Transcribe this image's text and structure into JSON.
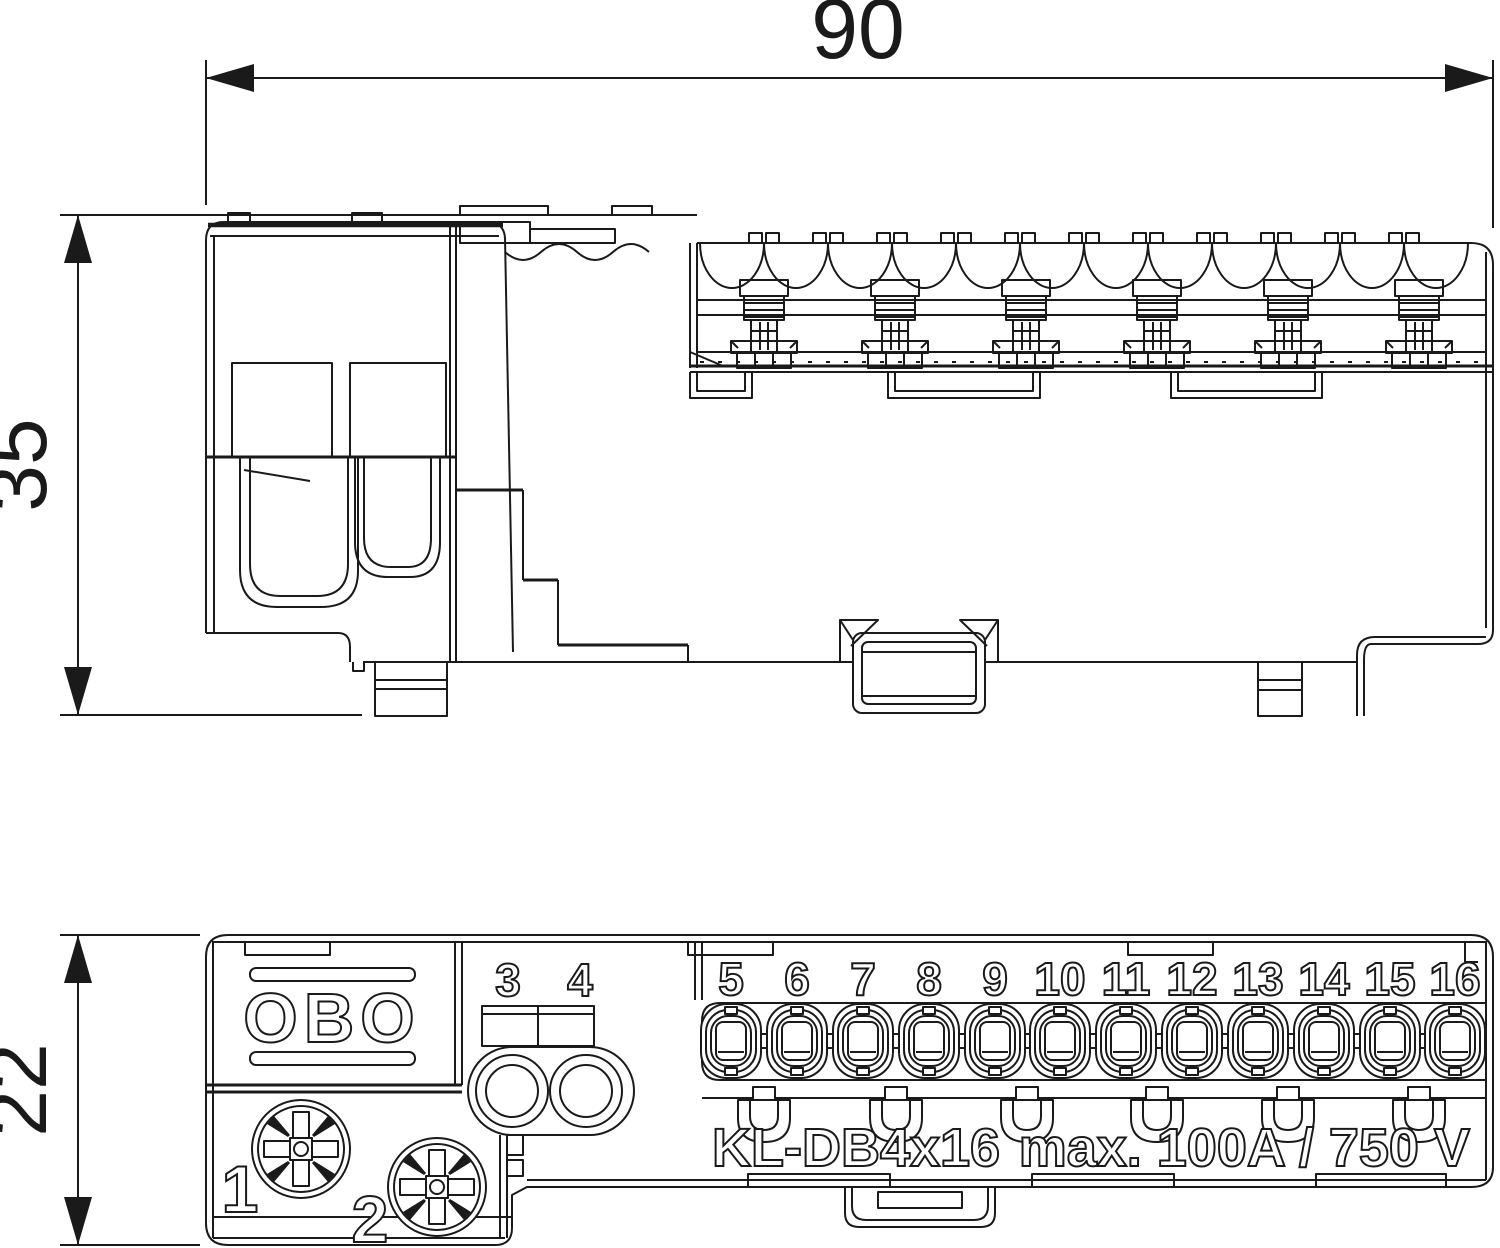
{
  "drawing": {
    "title": "Terminal block dimension drawing",
    "colors": {
      "line": "#1a1a1a",
      "background": "#ffffff"
    },
    "dimensions": {
      "width": "90",
      "side_height": "35",
      "plan_depth": "22"
    }
  },
  "top_view": {
    "description": "side elevation with scalloped terminal row, six screw posts and DIN rail clip"
  },
  "bottom_view": {
    "logo": "OBO",
    "screw_labels": [
      "1",
      "2"
    ],
    "port_labels": [
      "3",
      "4"
    ],
    "terminal_labels": [
      "5",
      "6",
      "7",
      "8",
      "9",
      "10",
      "11",
      "12",
      "13",
      "14",
      "15",
      "16"
    ],
    "model": "KL-DB4x16",
    "rating": "max. 100A / 750 V"
  }
}
